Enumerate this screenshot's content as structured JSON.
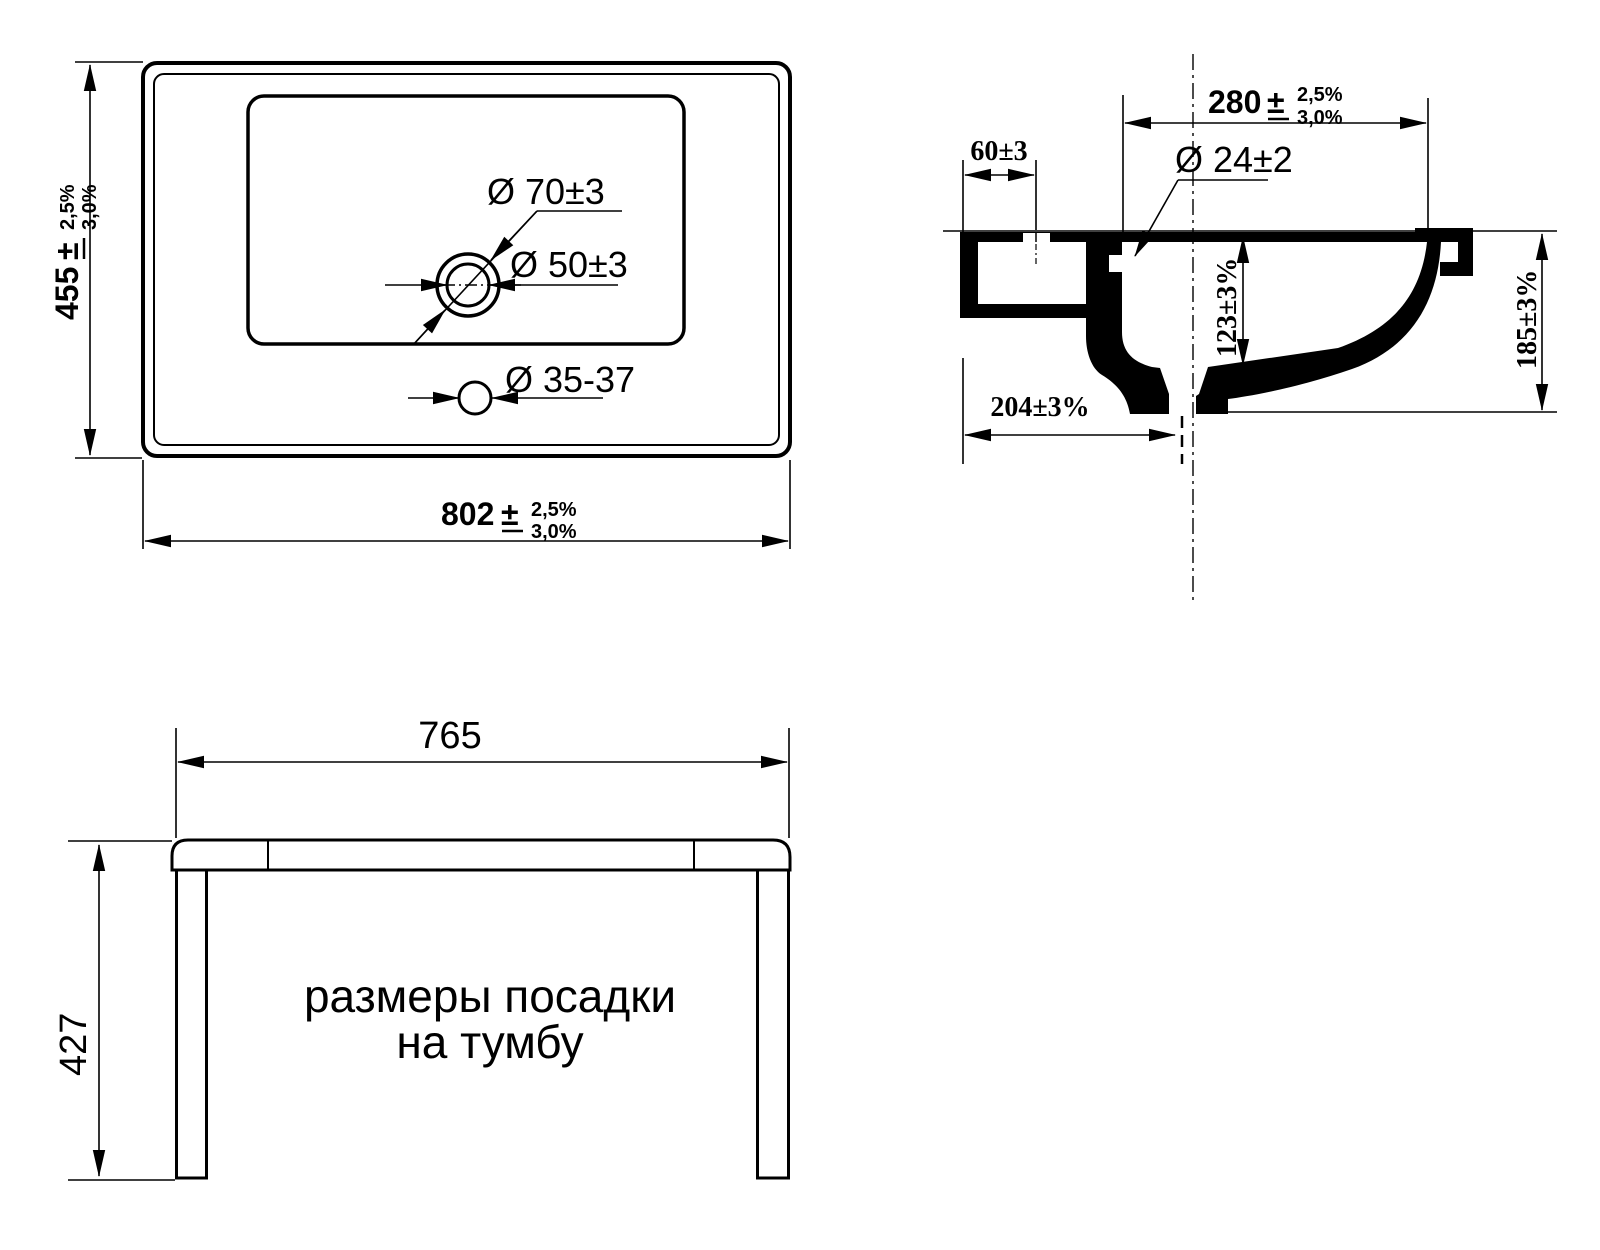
{
  "colors": {
    "background": "#ffffff",
    "line": "#000000"
  },
  "top_view": {
    "width_value": "802",
    "width_pm": "±",
    "width_tol_upper": "2,5%",
    "width_tol_lower": "3,0%",
    "height_value": "455",
    "height_pm": "±",
    "height_tol_upper": "2,5%",
    "height_tol_lower": "3,0%",
    "drain_outer_label": "Ø 70±3",
    "drain_inner_label": "Ø 50±3",
    "faucet_hole_label": "Ø 35-37"
  },
  "side_view": {
    "top_width_value": "280",
    "top_width_pm": "±",
    "top_width_tol_upper": "2,5%",
    "top_width_tol_lower": "3,0%",
    "back_edge_label": "60±3",
    "overflow_label": "Ø 24±2",
    "inner_depth_label": "123±3%",
    "total_height_label": "185±3%",
    "drain_offset_label": "204±3%"
  },
  "mounting_view": {
    "width_label": "765",
    "height_label": "427",
    "caption_line1": "размеры посадки",
    "caption_line2": "на тумбу"
  }
}
